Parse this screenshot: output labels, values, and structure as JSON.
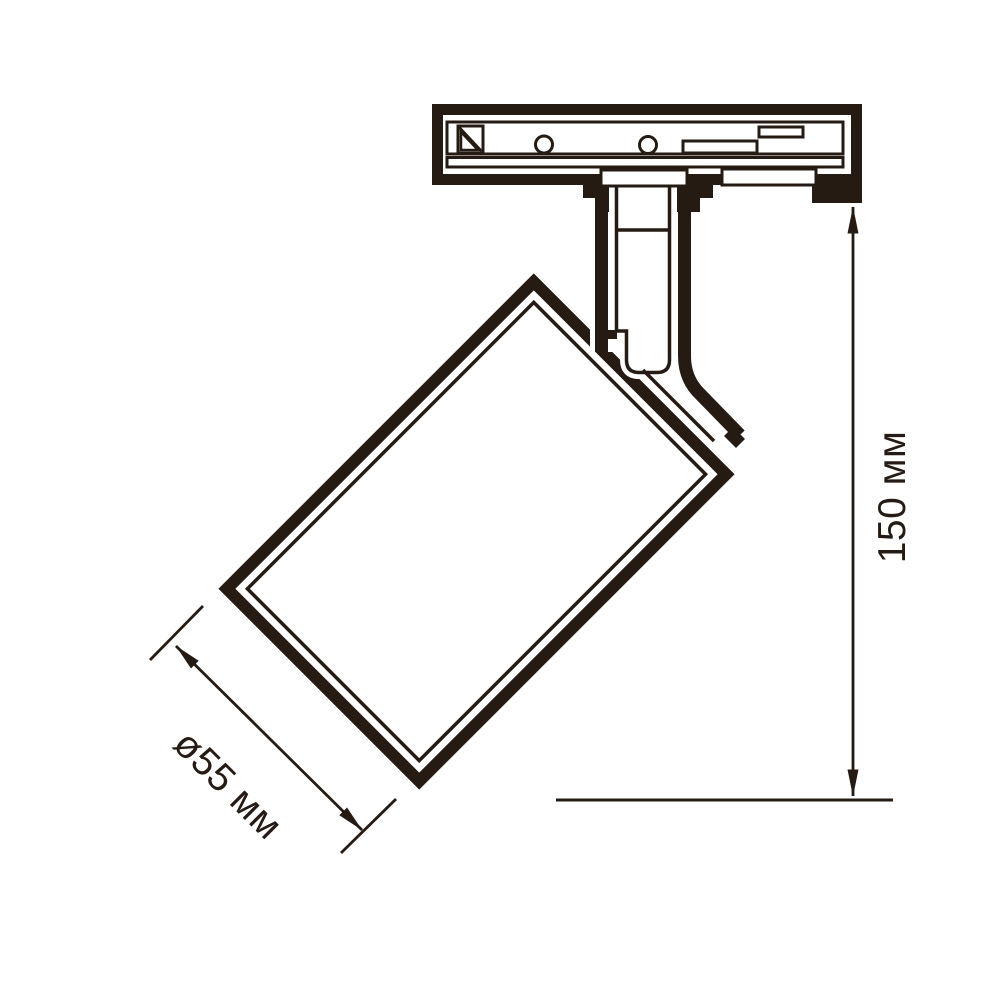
{
  "drawing": {
    "type": "technical-dimension-diagram",
    "subject": "track-mounted spotlight fixture side view",
    "dimensions": {
      "diameter": {
        "label": "ø55 мм"
      },
      "height": {
        "label": "150 мм"
      }
    },
    "colors": {
      "line": "#261b12",
      "background": "#ffffff"
    }
  }
}
